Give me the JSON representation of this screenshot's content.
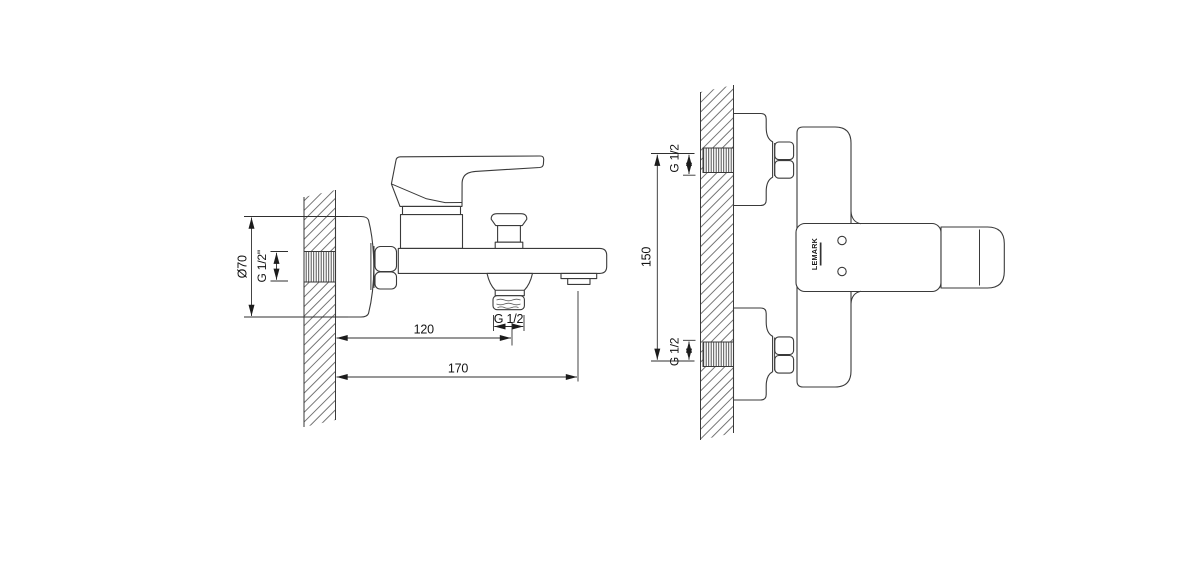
{
  "drawing": {
    "type": "technical-dimension-drawing",
    "subject": "wall-mounted bath mixer faucet, side view and top view",
    "colors": {
      "background": "#ffffff",
      "line": "#3a3a3a",
      "dimension_line": "#2f2f2f",
      "text": "#141414",
      "hatch": "#5f5f5f"
    },
    "side": {
      "flange_diameter": "Ø70",
      "inlet_thread": "G 1/2\"",
      "wall_to_shower_outlet": "120",
      "wall_to_spout_tip": "170",
      "shower_outlet_thread": "G 1/2"
    },
    "top": {
      "inlet_thread_top": "G 1/2",
      "inlet_spacing": "150",
      "inlet_thread_bottom": "G 1/2",
      "brand_mark": "LEMARK"
    }
  }
}
